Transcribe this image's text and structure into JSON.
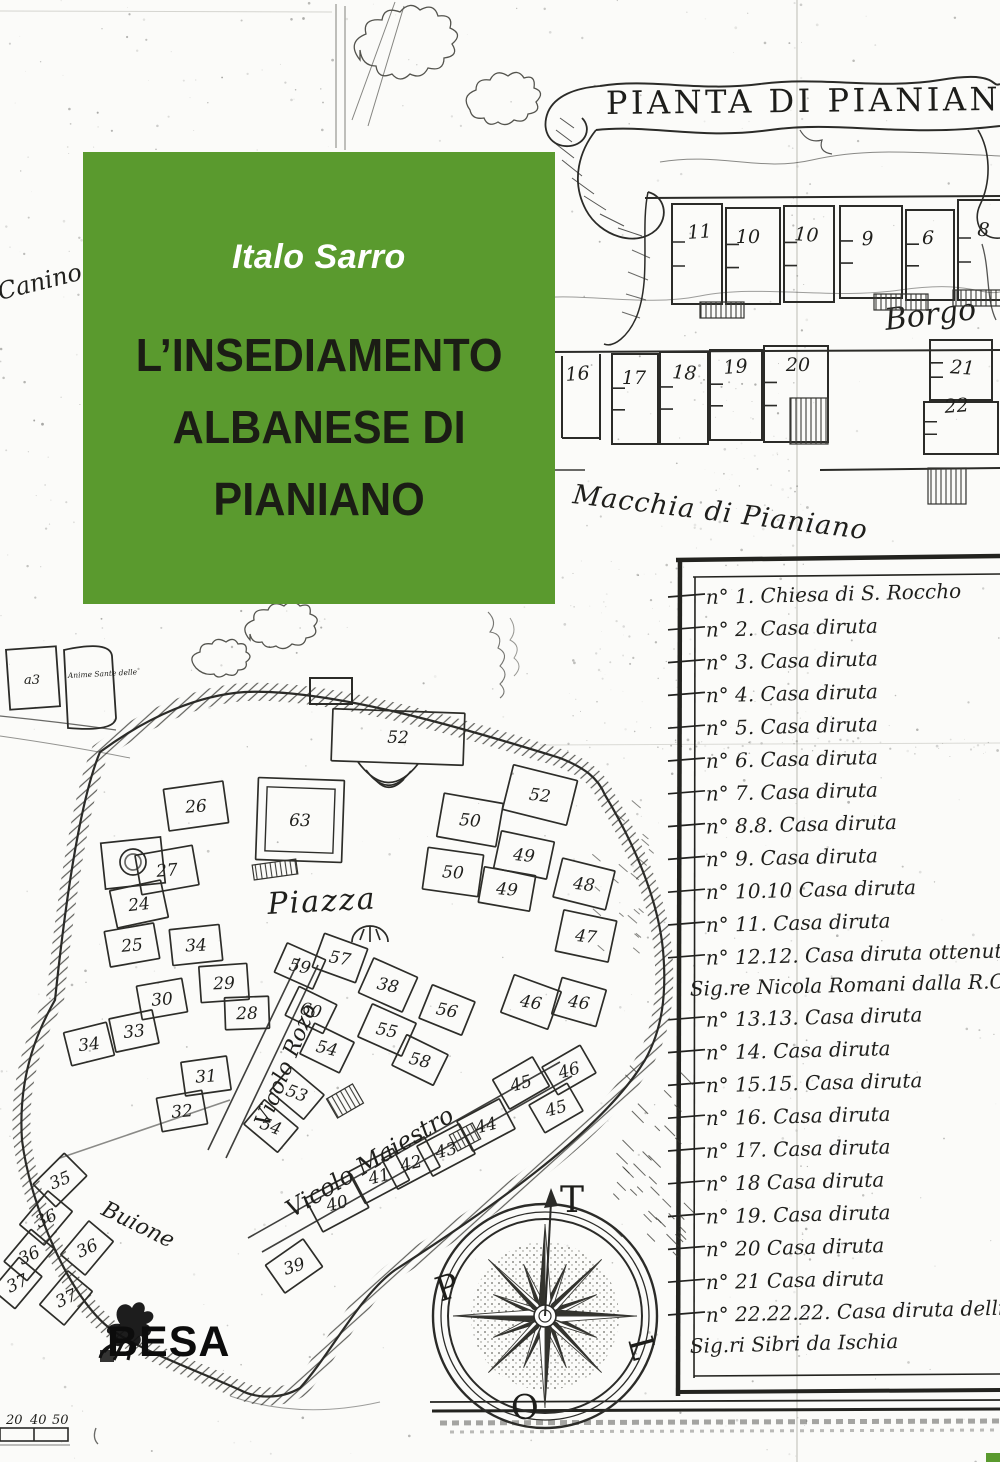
{
  "cover": {
    "author": "Italo Sarro",
    "title_lines": [
      "L’INSEDIAMENTO",
      "ALBANESE DI",
      "PIANIANO"
    ],
    "publisher_logo": "BESA",
    "colors": {
      "green": "#5a9a2e",
      "title": "#1b1d15",
      "ink": "#2b2b28",
      "paper": "#fbfbf9"
    }
  },
  "map": {
    "banner_title": "PIANTA DI PIANIANO",
    "place_labels": {
      "borgo": "Borgo",
      "macchia": "Macchia di Pianiano",
      "canino": "Canino",
      "piazza": "Piazza",
      "vicolo_rozo": "Vicolo Rozo",
      "vicolo_maiestro": "Vicolo Maiestro",
      "buione": "Buione",
      "anime_sante": "Anime Sante delle",
      "hut_mark": "a3"
    },
    "compass_points": {
      "north": "T",
      "west": "P",
      "east": "L",
      "south": "O"
    },
    "scale_bar_numbers": [
      "20",
      "40",
      "50"
    ],
    "borgo_room_numbers": [
      "11",
      "10",
      "10",
      "9",
      "6",
      "8",
      "16",
      "17",
      "18",
      "19",
      "20",
      "21",
      "22"
    ],
    "town_building_numbers": [
      "52",
      "52",
      "50",
      "50",
      "49",
      "49",
      "48",
      "47",
      "46",
      "46",
      "63",
      "26",
      "27",
      "24",
      "25",
      "34",
      "29",
      "30",
      "33",
      "34",
      "31",
      "32",
      "57",
      "38",
      "56",
      "55",
      "60",
      "54",
      "59",
      "53",
      "54",
      "40",
      "41",
      "42",
      "43",
      "44",
      "45",
      "45",
      "46",
      "36",
      "36",
      "36",
      "37",
      "37",
      "39",
      "35",
      "28",
      "58"
    ],
    "legend_entries": [
      [
        "n° 1. Chiesa di S. Roccho"
      ],
      [
        "n° 2. Casa diruta"
      ],
      [
        "n° 3. Casa diruta"
      ],
      [
        "n° 4. Casa diruta"
      ],
      [
        "n° 5. Casa diruta"
      ],
      [
        "n° 6. Casa diruta"
      ],
      [
        "n° 7. Casa diruta"
      ],
      [
        "n° 8.8. Casa diruta"
      ],
      [
        "n° 9. Casa diruta"
      ],
      [
        "n° 10.10 Casa diruta"
      ],
      [
        "n° 11. Casa diruta"
      ],
      [
        "n° 12.12. Casa diruta ottenuta dal",
        "Sig.re Nicola Romani dalla R.C.A."
      ],
      [
        "n° 13.13. Casa diruta"
      ],
      [
        "n° 14. Casa diruta"
      ],
      [
        "n° 15.15. Casa diruta"
      ],
      [
        "n° 16. Casa diruta"
      ],
      [
        "n° 17. Casa diruta"
      ],
      [
        "n° 18 Casa diruta"
      ],
      [
        "n° 19. Casa diruta"
      ],
      [
        "n° 20 Casa diruta"
      ],
      [
        "n° 21 Casa diruta"
      ],
      [
        "n° 22.22.22. Casa diruta delli",
        "Sig.ri Sibri da Ischia"
      ]
    ]
  }
}
